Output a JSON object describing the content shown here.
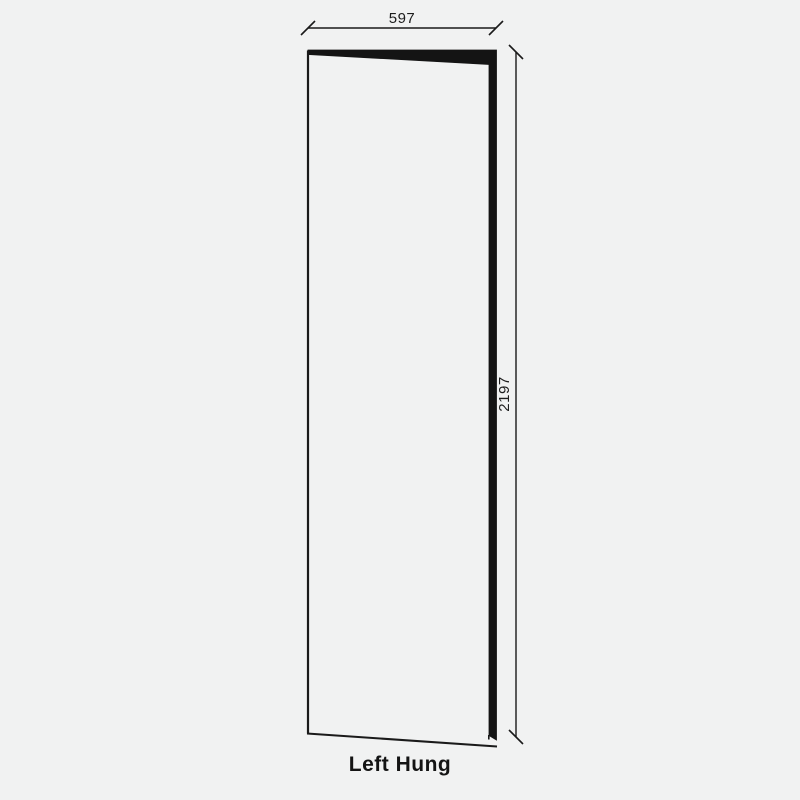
{
  "diagram": {
    "label": "Left Hung",
    "dimensions": {
      "width": {
        "value": "597"
      },
      "height": {
        "value": "2197"
      }
    },
    "colors": {
      "background": "#f1f2f2",
      "line": "#1a1a1a",
      "door_edge_fill": "#141414",
      "text": "#1d1d1d"
    }
  }
}
